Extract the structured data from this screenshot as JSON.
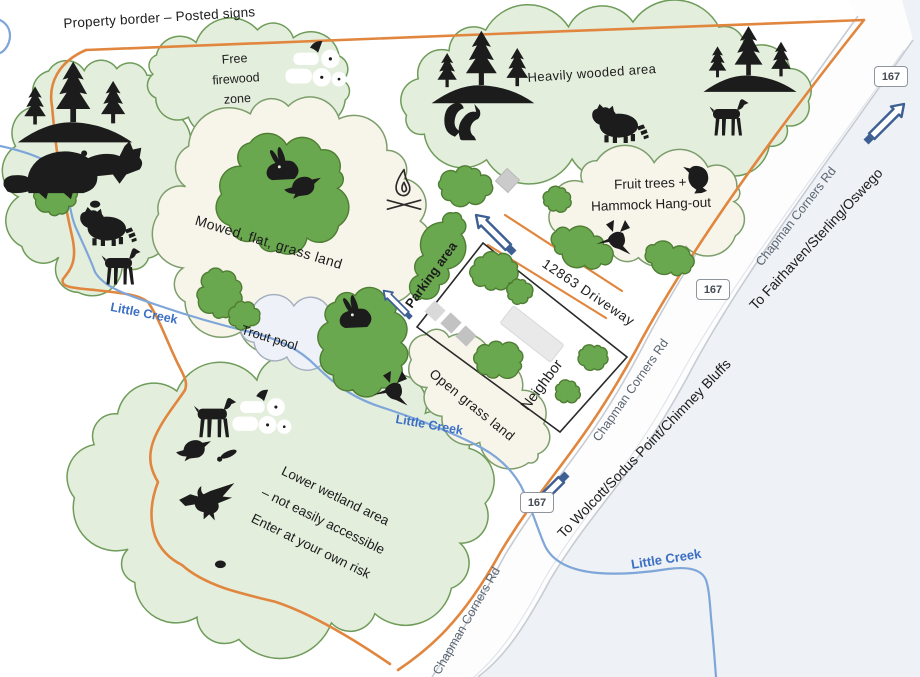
{
  "map": {
    "property_border_label": "Property border – Posted signs",
    "areas": {
      "free_firewood_lines": [
        "Free",
        "firewood",
        "zone"
      ],
      "heavily_wooded": "Heavily wooded area",
      "mowed_grass": "Mowed, flat, grass land",
      "fruit_hammock_lines": [
        "Fruit trees +",
        "Hammock Hang-out"
      ],
      "trout_pool": "Trout pool",
      "open_grass": "Open grass land",
      "wetland_lines": [
        "Lower wetland area",
        "– not easily accessible",
        "Enter at your own risk"
      ]
    },
    "roads": {
      "route_number": "167",
      "road_name": "Chapman Corners Rd",
      "driveway_label": "12863 Driveway",
      "direction_northeast": "To Fairhaven/Sterling/Oswego",
      "direction_southwest": "To Wolcott/Sodus Point/Chimney Bluffs"
    },
    "water": {
      "creek_name": "Little Creek"
    },
    "sites": {
      "parking": "Parking area",
      "neighbor": "Neighbor"
    },
    "icons": [
      "pine-trees",
      "beaver",
      "fox",
      "snake",
      "raccoon",
      "deer",
      "squirrel",
      "rabbit",
      "songbird",
      "crow",
      "hummingbird",
      "eagle",
      "mosquito",
      "firewood-logs-axe",
      "campfire",
      "direction-arrow",
      "firepit-pad",
      "parking-spot",
      "neighbor-house"
    ],
    "colors": {
      "property_border": "#e0863e",
      "cloud_green_fill": "#e4eedd",
      "cloud_green_stroke": "#6f9c5a",
      "cloud_cream_fill": "#f7f5ea",
      "pool_fill": "#eef1f7",
      "bush_fill": "#6aa84f",
      "bush_stroke": "#4e7d33",
      "creek_blue": "#7fa6d9",
      "creek_label_blue": "#3b6fc4",
      "road_edge": "#c7ccd4",
      "offmap_background": "#eef1f5",
      "arrow_blue": "#3d5f94",
      "icon_black": "#1c1c1c"
    }
  }
}
